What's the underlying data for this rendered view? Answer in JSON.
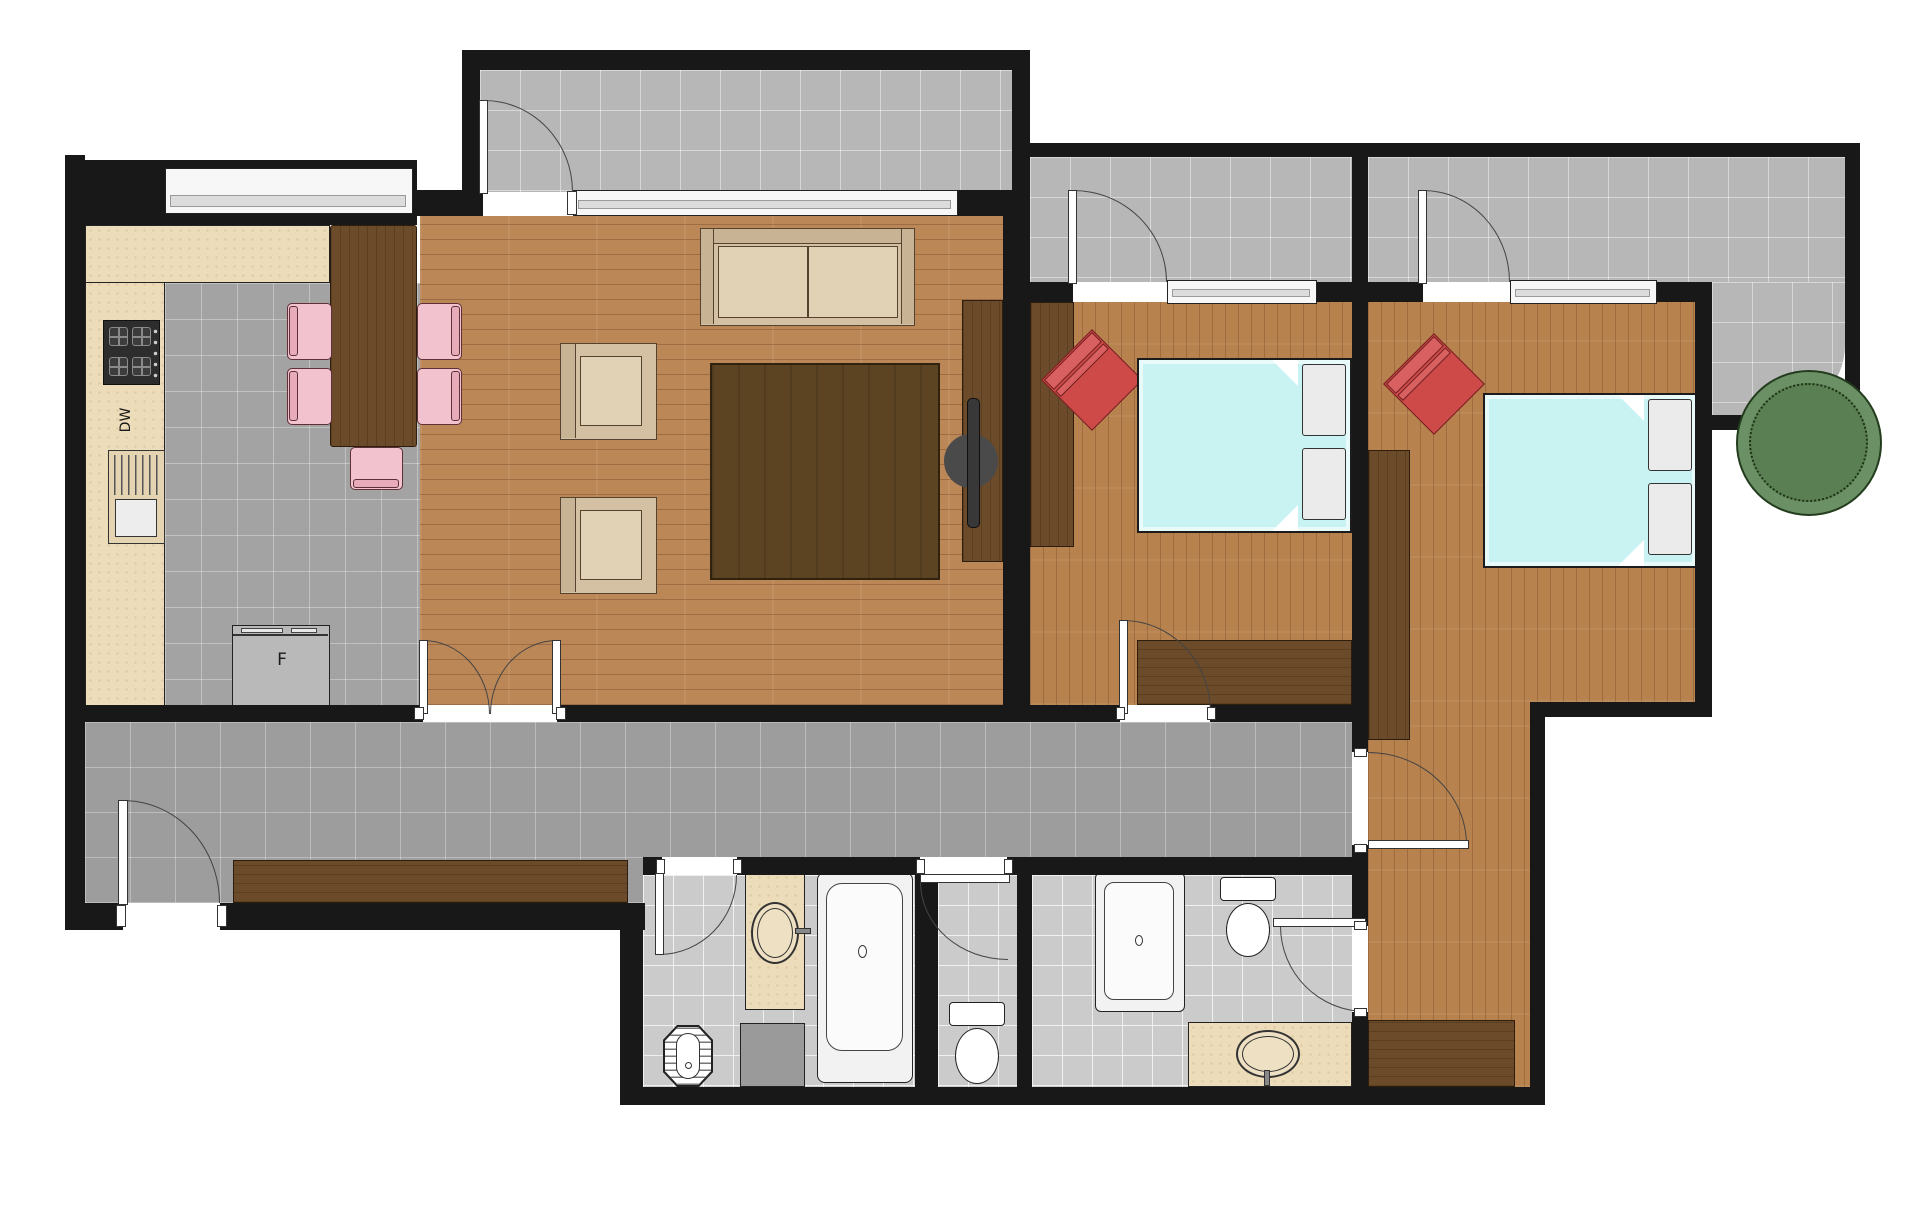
{
  "title": "apartment-floor-plan",
  "labels": {
    "dishwasher": "DW",
    "fridge": "F"
  },
  "colors": {
    "wall": "#181818",
    "wood_floor": "#bc8756",
    "bedroom_floor": "#b8824f",
    "dark_walnut_furniture": "#6b4b29",
    "rug": "#5c4423",
    "corridor_tile": "#9d9d9d",
    "kitchen_tile": "#a3a3a3",
    "balcony_tile": "#b7b7b7",
    "bathroom_tile": "#cbcbcb",
    "counter_beige": "#ecdcba",
    "bed_cyan": "#c9f2f2",
    "chair_pink": "#f2c3ce",
    "armchair_red": "#ce4a49",
    "sofa_beige": "#d4c1a4",
    "tree_green": "#6b9065",
    "fixture_white": "#ffffff"
  },
  "rooms": [
    {
      "name": "kitchen-dining",
      "items": [
        "stove",
        "dishwasher",
        "kitchen-sink",
        "fridge",
        "l-counter",
        "dining-table",
        "pink-chair x5",
        "window"
      ]
    },
    {
      "name": "living-room",
      "items": [
        "sofa",
        "armchair x2",
        "area-rug",
        "tv",
        "media-panel",
        "french-doors",
        "balcony-door",
        "window"
      ]
    },
    {
      "name": "living-balcony",
      "items": []
    },
    {
      "name": "bedroom-1",
      "items": [
        "double-bed",
        "pillows x2",
        "red-accent-chair",
        "wardrobe",
        "foot-dresser",
        "balcony-door",
        "window"
      ]
    },
    {
      "name": "bedroom-2",
      "items": [
        "double-bed",
        "pillows x2",
        "red-accent-chair",
        "wardrobe",
        "bottom-dresser",
        "balcony-door",
        "window"
      ]
    },
    {
      "name": "bedroom-balcony-1",
      "items": []
    },
    {
      "name": "bedroom-balcony-2",
      "items": [
        "tree-planter"
      ]
    },
    {
      "name": "hallway",
      "items": [
        "entry-door",
        "console-sideboard"
      ]
    },
    {
      "name": "bathroom-1",
      "items": [
        "bathtub",
        "vanity-sink",
        "washing-machine",
        "towel-radiator"
      ]
    },
    {
      "name": "wc",
      "items": [
        "toilet"
      ]
    },
    {
      "name": "bathroom-2-ensuite",
      "items": [
        "shower",
        "toilet",
        "vanity-sink"
      ]
    }
  ]
}
